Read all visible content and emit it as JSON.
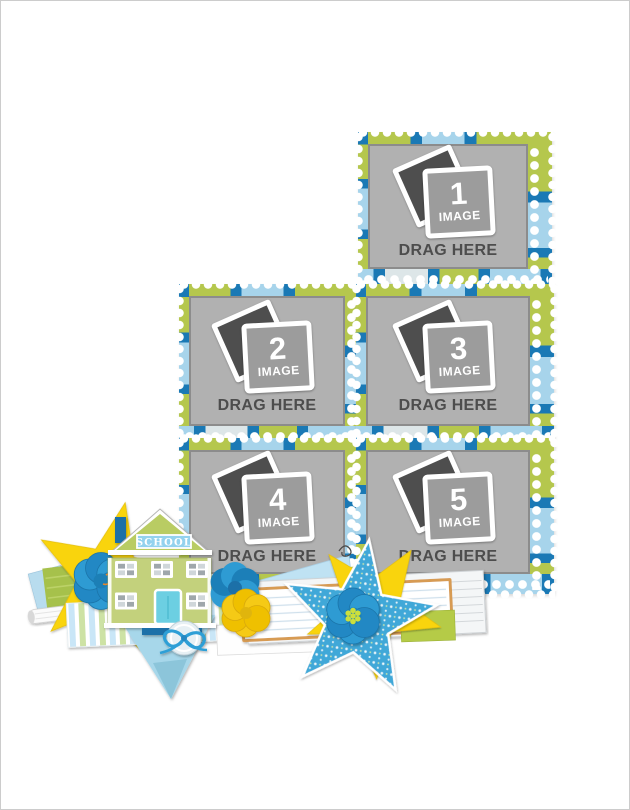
{
  "canvas": {
    "background": "#ffffff",
    "border_color": "#cccccc"
  },
  "slots": [
    {
      "id": 1,
      "number": "1",
      "image_label": "IMAGE",
      "drag_label": "DRAG HERE"
    },
    {
      "id": 2,
      "number": "2",
      "image_label": "IMAGE",
      "drag_label": "DRAG HERE"
    },
    {
      "id": 3,
      "number": "3",
      "image_label": "IMAGE",
      "drag_label": "DRAG HERE"
    },
    {
      "id": 4,
      "number": "4",
      "image_label": "IMAGE",
      "drag_label": "DRAG HERE"
    },
    {
      "id": 5,
      "number": "5",
      "image_label": "IMAGE",
      "drag_label": "DRAG HERE"
    }
  ],
  "decorations": {
    "school_sign_label": "SCHOOL"
  },
  "icons": {
    "photo_stack_icon": "two overlapping photo squares",
    "school_house_icon": "green schoolhouse with blue roof sign",
    "yellow_star_icon": "five point yellow star",
    "patterned_star_icon": "blue star with tiny white stars",
    "flower_icon": "layered round petal flower",
    "button_icon": "round button with blue cord bow",
    "pennant_icon": "light blue triangle pennant",
    "notepad_icon": "ruled white notepad with tan edge",
    "ribbon_icon": "pastel striped ribbon banner",
    "paper_roll_icon": "rolled white paper"
  },
  "colors": {
    "frame_blue": "#1a79b5",
    "frame_green": "#b5c74d",
    "frame_light_blue": "#a7d4eb",
    "frame_pale": "#dde6e8",
    "placeholder_gray": "#b1b1b1",
    "photo_back_gray": "#4e4e4e",
    "photo_front_gray": "#9c9c9c",
    "drag_text_gray": "#4d4d4d",
    "star_yellow": "#f9d410",
    "star_blue": "#3fa8d8",
    "flower_blue": "#2e9bd3",
    "flower_center_green": "#cbdf3d",
    "house_green": "#c3d17c",
    "roof_green": "#b9cc63",
    "door_teal": "#6ccfe2",
    "sign_blue": "#93d2ee",
    "chimney_blue": "#1d6fa8",
    "pennant_blue": "#a7d7ea",
    "strip_green": "#b5cb47",
    "notepad_tan": "#d79b52"
  }
}
